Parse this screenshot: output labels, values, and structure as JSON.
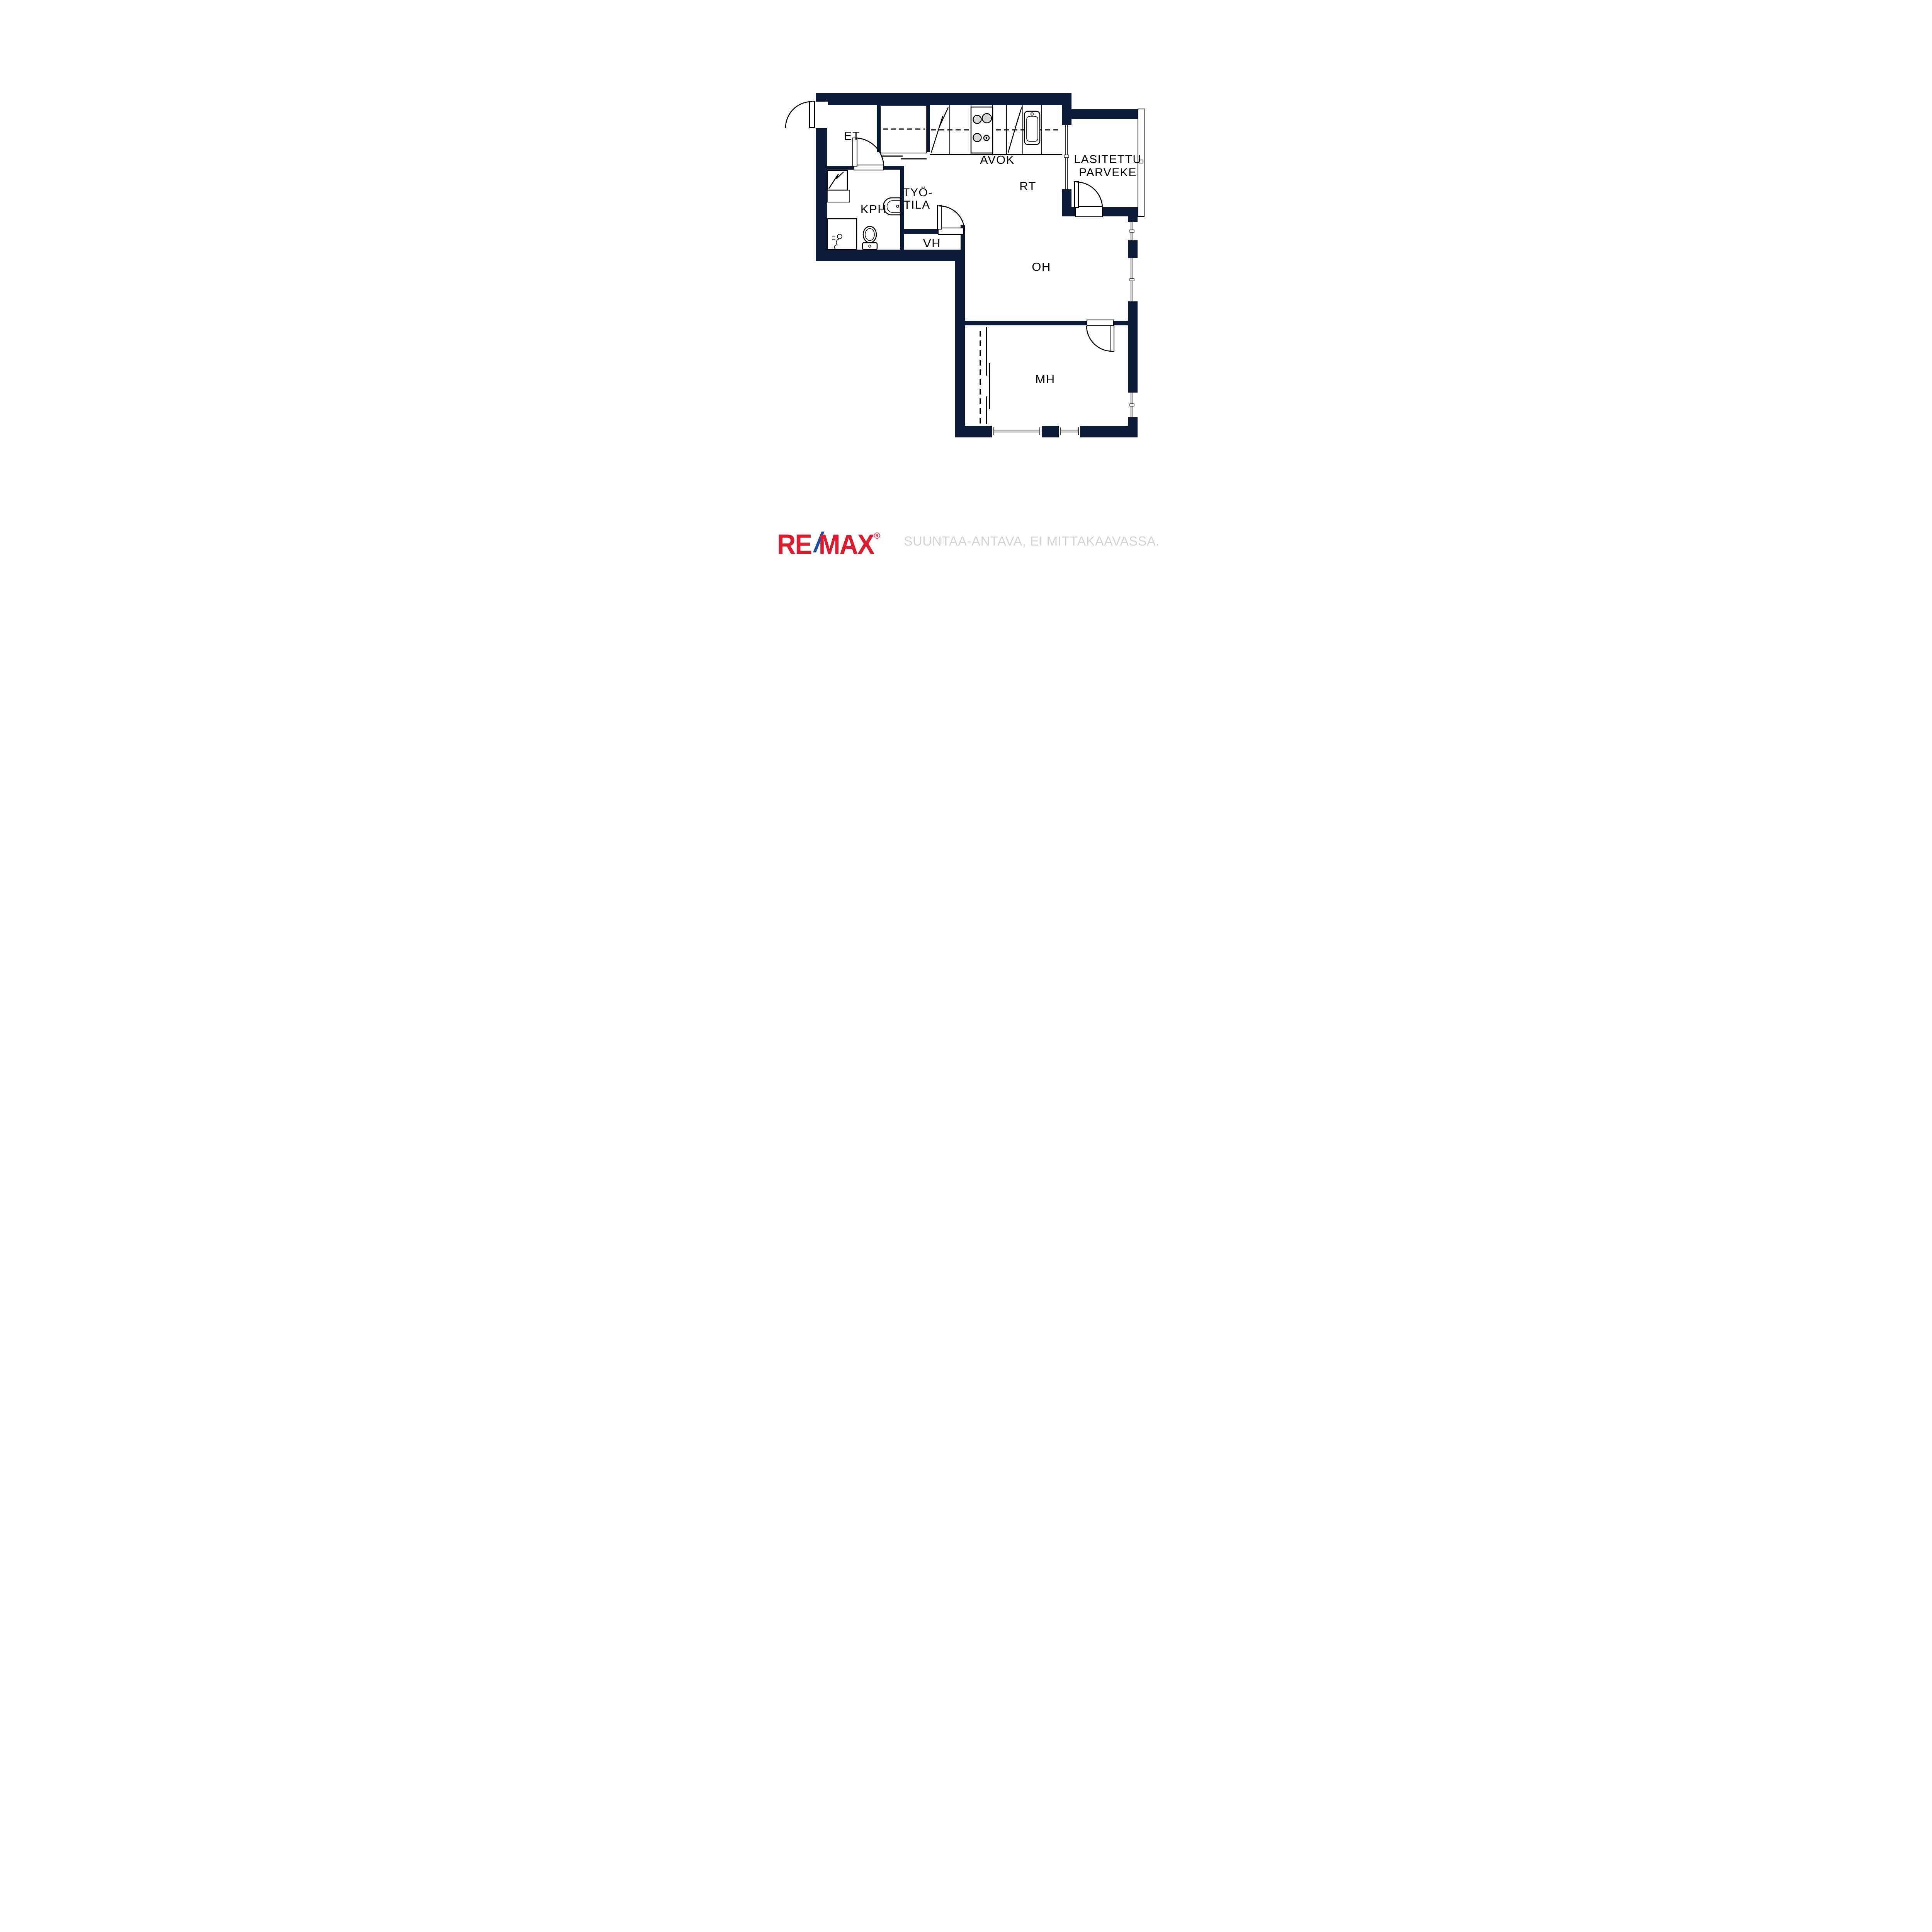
{
  "page": {
    "background": "#ffffff"
  },
  "colors": {
    "wall": "#0c1936",
    "line": "#000000",
    "burner_gray": "#d9d9d9",
    "brand_red": "#dc1c2e",
    "brand_blue": "#1b4fa0",
    "disclaimer_gray": "#d3d3d3"
  },
  "rooms": {
    "et": {
      "label": "ET"
    },
    "avok": {
      "label": "AVOK"
    },
    "parveke": {
      "line1": "LASITETTU",
      "line2": "PARVEKE"
    },
    "kph": {
      "label": "KPH"
    },
    "tyotila": {
      "line1": "TYÖ-",
      "line2": "TILA"
    },
    "rt": {
      "label": "RT"
    },
    "vh": {
      "label": "VH"
    },
    "oh": {
      "label": "OH"
    },
    "mh": {
      "label": "MH"
    }
  },
  "footer": {
    "brand": {
      "re": "RE",
      "slash": "/",
      "max": "MAX",
      "registered": "®"
    },
    "disclaimer": "SUUNTAA-ANTAVA, EI MITTAKAAVASSA."
  }
}
